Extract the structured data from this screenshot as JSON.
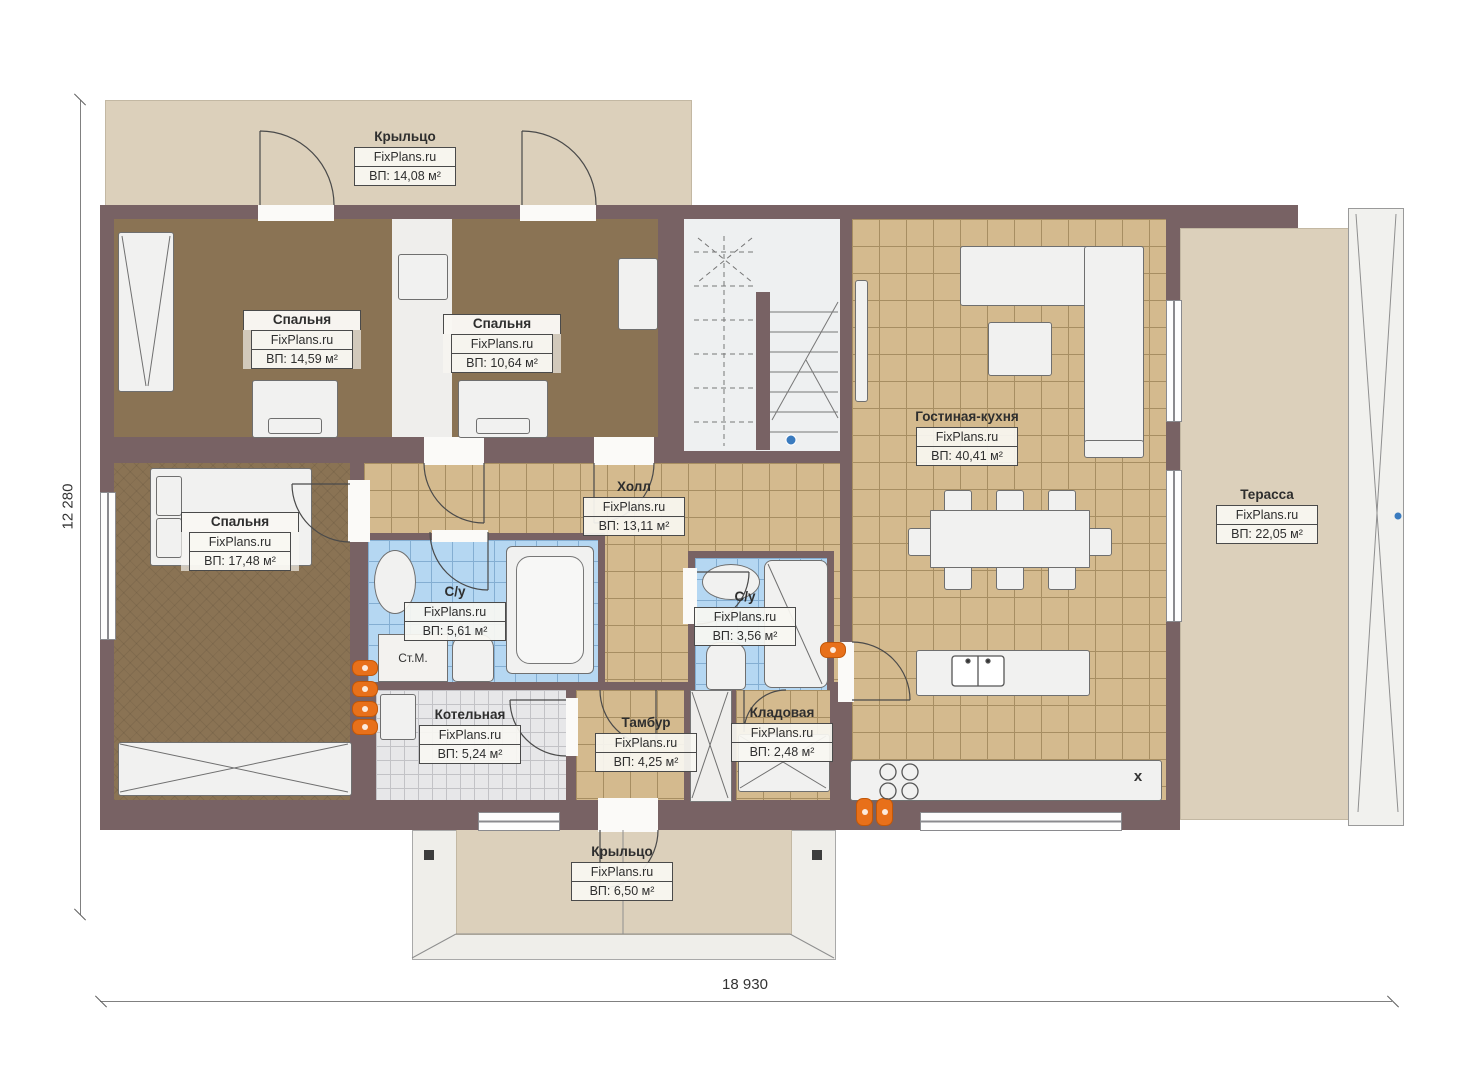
{
  "dimensions": {
    "height_label": "12 280",
    "width_label": "18 930"
  },
  "rooms": [
    {
      "key": "porch_top",
      "name": "Крыльцо",
      "brand": "FixPlans.ru",
      "area": "ВП: 14,08 м²"
    },
    {
      "key": "bedroom_1",
      "name": "Спальня",
      "brand": "FixPlans.ru",
      "area": "ВП: 14,59 м²"
    },
    {
      "key": "bedroom_2",
      "name": "Спальня",
      "brand": "FixPlans.ru",
      "area": "ВП: 10,64 м²"
    },
    {
      "key": "bedroom_3",
      "name": "Спальня",
      "brand": "FixPlans.ru",
      "area": "ВП: 17,48 м²"
    },
    {
      "key": "hall",
      "name": "Холл",
      "brand": "FixPlans.ru",
      "area": "ВП: 13,11 м²"
    },
    {
      "key": "living_kitchen",
      "name": "Гостиная-кухня",
      "brand": "FixPlans.ru",
      "area": "ВП: 40,41 м²"
    },
    {
      "key": "terrace",
      "name": "Терасса",
      "brand": "FixPlans.ru",
      "area": "ВП: 22,05 м²"
    },
    {
      "key": "bath_1",
      "name": "С/у",
      "brand": "FixPlans.ru",
      "area": "ВП: 5,61 м²"
    },
    {
      "key": "bath_2",
      "name": "С/у",
      "brand": "FixPlans.ru",
      "area": "ВП: 3,56 м²"
    },
    {
      "key": "boiler",
      "name": "Котельная",
      "brand": "FixPlans.ru",
      "area": "ВП: 5,24 м²"
    },
    {
      "key": "vestibule",
      "name": "Тамбур",
      "brand": "FixPlans.ru",
      "area": "ВП: 4,25 м²"
    },
    {
      "key": "storage",
      "name": "Кладовая",
      "brand": "FixPlans.ru",
      "area": "ВП: 2,48 м²"
    },
    {
      "key": "porch_bottom",
      "name": "Крыльцо",
      "brand": "FixPlans.ru",
      "area": "ВП: 6,50 м²"
    }
  ],
  "annotations": {
    "washing_machine": "Ст.М.",
    "kitchen_mark": "x"
  },
  "colors": {
    "wall": "#786264",
    "tile": "#d4ba8e",
    "bedroom_floor": "#8a7354",
    "wet_tile": "#b5d7f2",
    "porch": "#dcd0bb",
    "accent_orange": "#e8701a"
  }
}
